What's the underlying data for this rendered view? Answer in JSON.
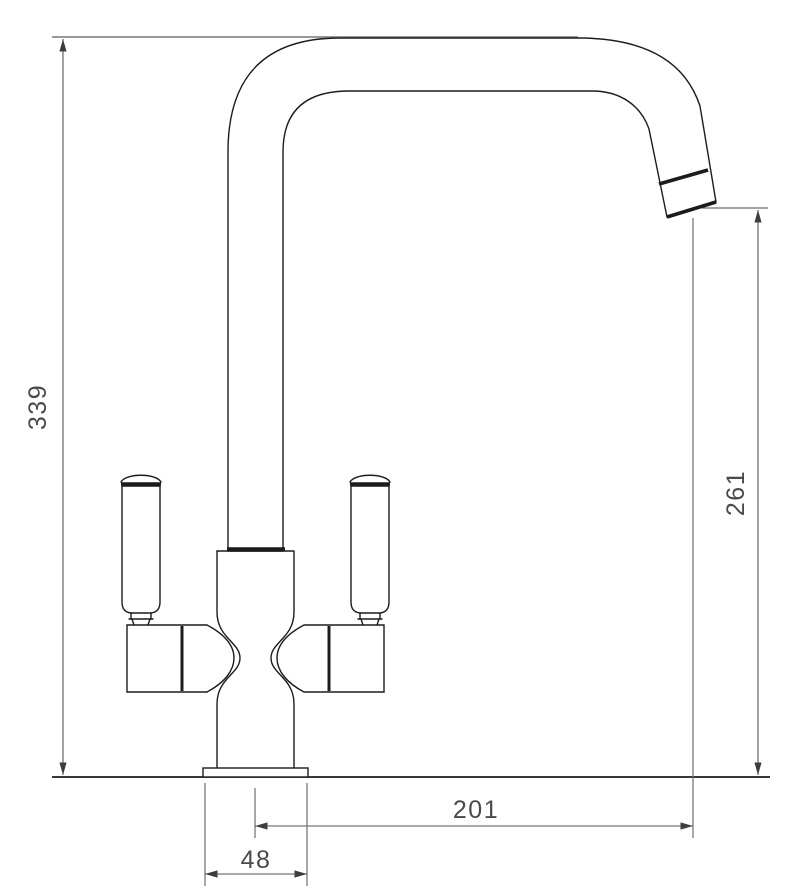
{
  "drawing": {
    "kind": "technical dimension drawing",
    "subject": "twin-lever kitchen mixer tap, front elevation",
    "background": "#ffffff",
    "outline_color": "#1c1c1c",
    "dimension_line_color": "#555555",
    "dimension_text_color": "#4a4a4a"
  },
  "dimensions": {
    "overall_height": {
      "label": "339",
      "axis": "vertical",
      "location": "left of tap, base line to top of spout"
    },
    "spout_outlet_height": {
      "label": "261",
      "axis": "vertical",
      "location": "right of tap, base line to underside of spout outlet"
    },
    "spout_reach": {
      "label": "201",
      "axis": "horizontal",
      "location": "below base, tap centre line to spout outlet"
    },
    "base_width": {
      "label": "48",
      "axis": "horizontal",
      "location": "below base, width of base flange"
    }
  }
}
